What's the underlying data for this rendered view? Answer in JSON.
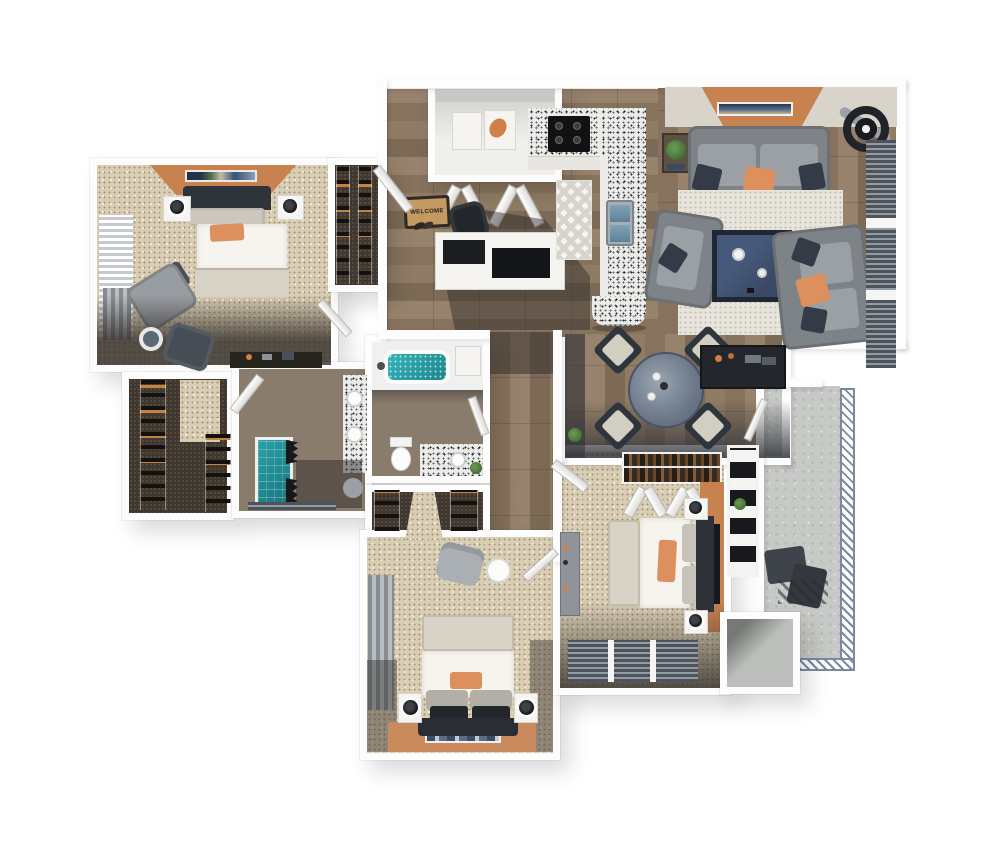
{
  "welcome_mat": {
    "text": "WELCOME"
  },
  "palette": {
    "background": "#ffffff",
    "wall": "#fdfdfd",
    "carpet": "#d9cdb4",
    "wood_floor": "#8d7962",
    "concrete": "#c7c9c6",
    "granite_counter": "#ebebe8",
    "accent_orange_wall": "#c8824f",
    "accent_orange_pillow": "#dd8f5e",
    "sofa_gray": "#7e8387",
    "navy_table_art": "#3d5068",
    "teal_water": "#2aa3a9",
    "dark_furniture": "#2b2e33",
    "area_rug": "#e7e4dc",
    "railing_blue": "#7b8aa0",
    "plant_green": "#4c7a3d"
  },
  "rooms": [
    {
      "name": "bedroom-1",
      "floor": "carpet",
      "furniture": [
        "bed",
        "nightstands",
        "lamps",
        "armchair",
        "ottoman",
        "side-table",
        "desk",
        "window-blinds",
        "accent-wall"
      ]
    },
    {
      "name": "coat-closet",
      "floor": "dark-carpet",
      "furniture": [
        "shelves"
      ]
    },
    {
      "name": "foyer",
      "floor": "wood",
      "furniture": [
        "welcome-mat",
        "shoes",
        "office-desk",
        "office-chair"
      ]
    },
    {
      "name": "laundry-closet",
      "floor": "vinyl",
      "furniture": [
        "washer",
        "dryer",
        "bifold-doors"
      ]
    },
    {
      "name": "kitchen",
      "floor": "wood",
      "furniture": [
        "granite-counter",
        "stove",
        "sink",
        "chevron-runner-rug",
        "peninsula"
      ]
    },
    {
      "name": "living-room",
      "floor": "wood",
      "furniture": [
        "sofa",
        "loveseat",
        "armchair-sofa",
        "coffee-table",
        "area-rug",
        "wall-art",
        "ceiling-fan",
        "plant-table",
        "window-blinds",
        "accent-wall"
      ]
    },
    {
      "name": "dining-area",
      "floor": "wood",
      "furniture": [
        "round-table",
        "four-chairs",
        "console-desk"
      ]
    },
    {
      "name": "hallway",
      "floor": "wood",
      "furniture": []
    },
    {
      "name": "bathroom-1",
      "floor": "wood",
      "furniture": [
        "double-vanity",
        "round-sinks",
        "shower",
        "towels",
        "stool"
      ]
    },
    {
      "name": "bathroom-2",
      "floor": "wood",
      "furniture": [
        "bathtub",
        "toilet",
        "vanity-sink",
        "plant"
      ]
    },
    {
      "name": "walk-in-closet",
      "floor": "dark-carpet",
      "furniture": [
        "shelves"
      ]
    },
    {
      "name": "linen-closet",
      "floor": "dark-carpet",
      "furniture": [
        "shelves"
      ]
    },
    {
      "name": "bedroom-2",
      "floor": "carpet",
      "furniture": [
        "bed",
        "nightstands",
        "lamps",
        "dresser",
        "closet-rod",
        "window-blinds",
        "accent-wall",
        "shelf-niche"
      ]
    },
    {
      "name": "bedroom-3",
      "floor": "carpet",
      "furniture": [
        "bed",
        "nightstands",
        "lamps",
        "chair",
        "round-table",
        "curtains",
        "accent-wall",
        "wall-art"
      ]
    },
    {
      "name": "balcony",
      "floor": "concrete",
      "furniture": [
        "railing",
        "lounge-chairs"
      ]
    },
    {
      "name": "storage-room",
      "floor": "concrete",
      "furniture": []
    }
  ]
}
